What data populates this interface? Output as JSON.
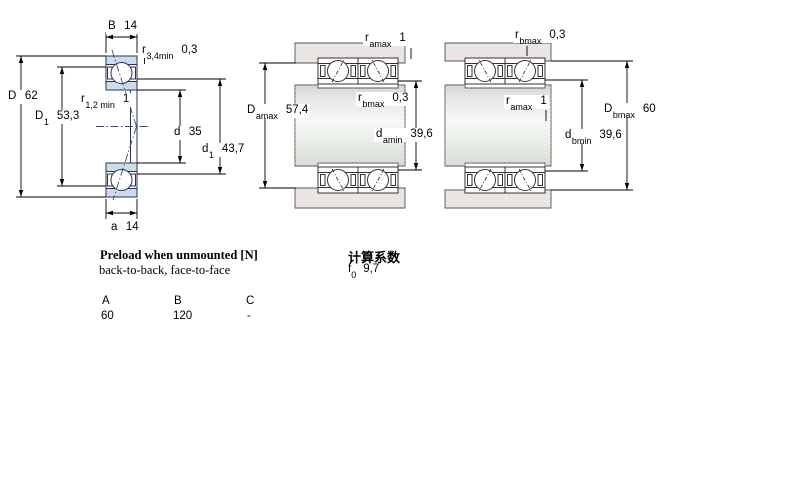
{
  "diagrams": {
    "left_single_bearing": {
      "labels": {
        "B": {
          "sym": "B",
          "sub": "",
          "val": "14"
        },
        "r34": {
          "sym": "r",
          "sub": "3,4min",
          "val": "0,3"
        },
        "D": {
          "sym": "D",
          "sub": "",
          "val": "62"
        },
        "D1": {
          "sym": "D",
          "sub": "1",
          "val": "53,3"
        },
        "r12": {
          "sym": "r",
          "sub": "1,2 min",
          "val": "1"
        },
        "d": {
          "sym": "d",
          "sub": "",
          "val": "35"
        },
        "d1": {
          "sym": "d",
          "sub": "1",
          "val": "43,7"
        },
        "a": {
          "sym": "a",
          "sub": "",
          "val": "14"
        }
      }
    },
    "back_to_back_mount": {
      "labels": {
        "ramax": {
          "sym": "r",
          "sub": "amax",
          "val": "1"
        },
        "rbmax": {
          "sym": "r",
          "sub": "bmax",
          "val": "0,3"
        },
        "Damax": {
          "sym": "D",
          "sub": "amax",
          "val": "57,4"
        },
        "damin": {
          "sym": "d",
          "sub": "amin",
          "val": "39,6"
        }
      }
    },
    "face_to_face_mount": {
      "labels": {
        "rbmax": {
          "sym": "r",
          "sub": "bmax",
          "val": "0,3"
        },
        "ramax": {
          "sym": "r",
          "sub": "amax",
          "val": "1"
        },
        "Dbmax": {
          "sym": "D",
          "sub": "bmax",
          "val": "60"
        },
        "dbmin": {
          "sym": "d",
          "sub": "bmin",
          "val": "39,6"
        }
      }
    }
  },
  "preload": {
    "title": "Preload when unmounted [N]",
    "subtitle": "back-to-back, face-to-face",
    "columns": [
      "A",
      "B",
      "C"
    ],
    "values": [
      "60",
      "120",
      "-"
    ]
  },
  "factors": {
    "title": "计算系数",
    "f0": {
      "sym": "f",
      "sub": "0",
      "val": "9,7"
    }
  },
  "colors": {
    "bearing_ring_fill": "#c5d7e8",
    "bearing_outline": "#2e3356",
    "housing_fill": "#e7e2e1",
    "shaft_tint_top": "#d5d1d4",
    "shaft_tint_bottom": "#d2dbd2",
    "dimension_lines": "#000000"
  }
}
